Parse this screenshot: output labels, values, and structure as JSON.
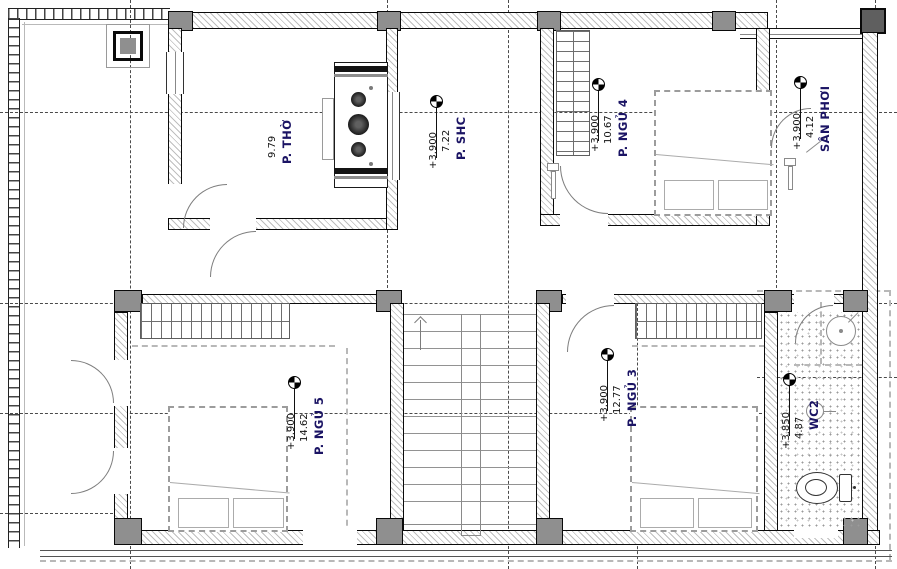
{
  "drawing": {
    "title": "Floor plan - upper storey (Vietnamese residence)",
    "rooms": [
      {
        "name": "P. THỜ",
        "area": "9.79",
        "level": ""
      },
      {
        "name": "P. SHC",
        "area": "7.22",
        "level": "+3.900"
      },
      {
        "name": "P. NGỦ 4",
        "area": "10.67",
        "level": "+3.900"
      },
      {
        "name": "SÂN PHƠI",
        "area": "4.12",
        "level": "+3.900"
      },
      {
        "name": "P. NGỦ 5",
        "area": "14.62",
        "level": "+3.900"
      },
      {
        "name": "P. NGỦ 3",
        "area": "12.77",
        "level": "+3.900"
      },
      {
        "name": "WC2",
        "area": "4.87",
        "level": "+3.850"
      }
    ],
    "colors": {
      "room_label": "#1b1464",
      "linework": "#111111",
      "wall_hatch": "#bfbfbf",
      "column_fill": "#8f8f8f"
    }
  }
}
